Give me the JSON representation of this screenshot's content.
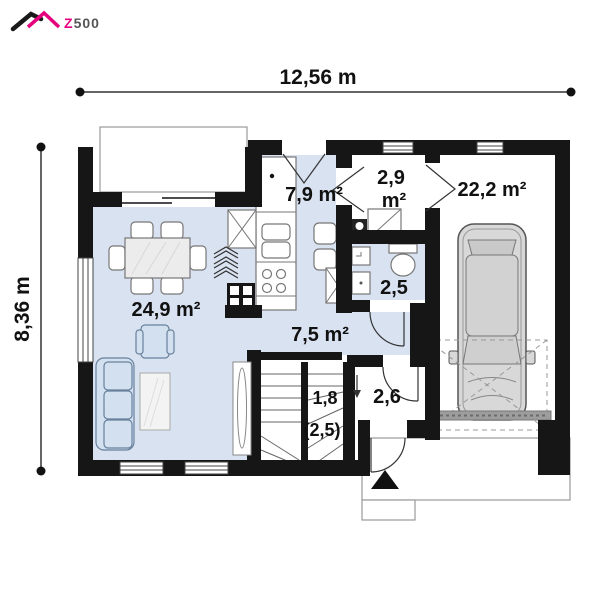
{
  "brand": {
    "z": "Z",
    "rest": "500"
  },
  "dimensions": {
    "width_label": "12,56 m",
    "height_label": "8,36 m"
  },
  "rooms": {
    "living": {
      "label": "24,9 m²"
    },
    "kitchen": {
      "label": "7,9 m²"
    },
    "hall": {
      "line1": "2,9",
      "line2": "m²"
    },
    "garage": {
      "label": "22,2 m²"
    },
    "bathroom": {
      "label": "2,5"
    },
    "corridor": {
      "label": "7,5 m²"
    },
    "stairs": {
      "line1": "1,8",
      "line2": "(2,5)",
      "direction_arrow": "↓"
    },
    "vestibule": {
      "label": "2,6"
    }
  },
  "colors": {
    "accent": "#e5007d",
    "wall": "#161616",
    "floor_blue": "#d9e2f0",
    "furniture_blue": "#d3e0ef"
  }
}
